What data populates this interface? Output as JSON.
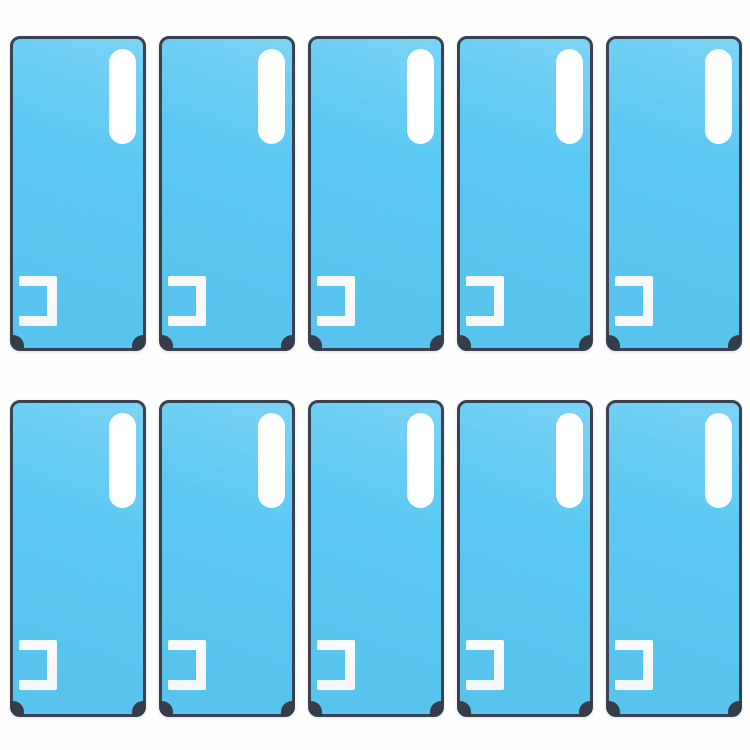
{
  "page": {
    "description": "Product photo of identical light-blue phone back-cover adhesive sticker sheets arranged in a grid on a plain white background. Each sheet has a dark slate outline, a white vertical pill-shaped camera cutout near the top right, a white left-open bracket cutout near the bottom left, and dark rounded tabs at both bottom corners.",
    "background_color": "#FEFEFE"
  },
  "grid": {
    "rows": 2,
    "columns": 5,
    "total_items": 10
  },
  "sticker": {
    "label": "back-cover-adhesive-sticker",
    "fill_color": "#5AC9F3",
    "border_color": "#3A4150",
    "cutout_color": "#FFFFFF",
    "corner_tab_color": "#353C4A",
    "cutouts": [
      "camera-pill-cutout",
      "left-open-bracket-cutout",
      "bottom-left-corner-tab",
      "bottom-right-corner-tab"
    ]
  }
}
